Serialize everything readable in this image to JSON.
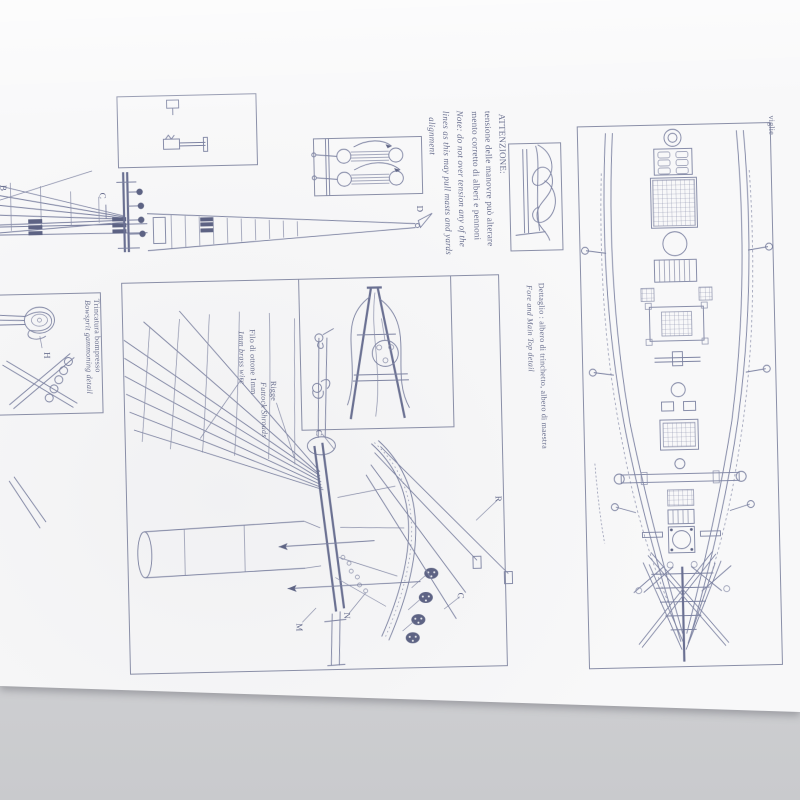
{
  "colors": {
    "background": "#d4d5d7",
    "paper": "#f8f8f9",
    "ink": "#7d83a2",
    "ink_dark": "#5d6384",
    "caption_text": "#6b7190"
  },
  "captions": {
    "caution": [
      "ATTENZIONE:",
      "tensione delle manovre può alterare",
      "mento corretto di alberi e pennoni",
      "Note: do not over tension any of the",
      "lines as this may pull masts and yards",
      "alignment"
    ],
    "detail_it": "Dettaglio : albero di trinchetto, albero di maestra",
    "detail_en": "Fore and Main Top detail",
    "gammoning_it": "Trincatura bompresso",
    "gammoning_en": "Bowsprit gammoning detail",
    "wire_it": "Filo di ottone 1mm",
    "wire_en": "1mm brass wire",
    "futtock_it": "Rigge",
    "futtock_en": "Futtock Shrouds",
    "edge_fragment": "viglie"
  },
  "part_labels": {
    "b": "B",
    "c_mast": "C",
    "d": "D",
    "h": "H",
    "c_top": "C",
    "r": "R",
    "c_lower": "C",
    "n": "N",
    "m": "M"
  }
}
